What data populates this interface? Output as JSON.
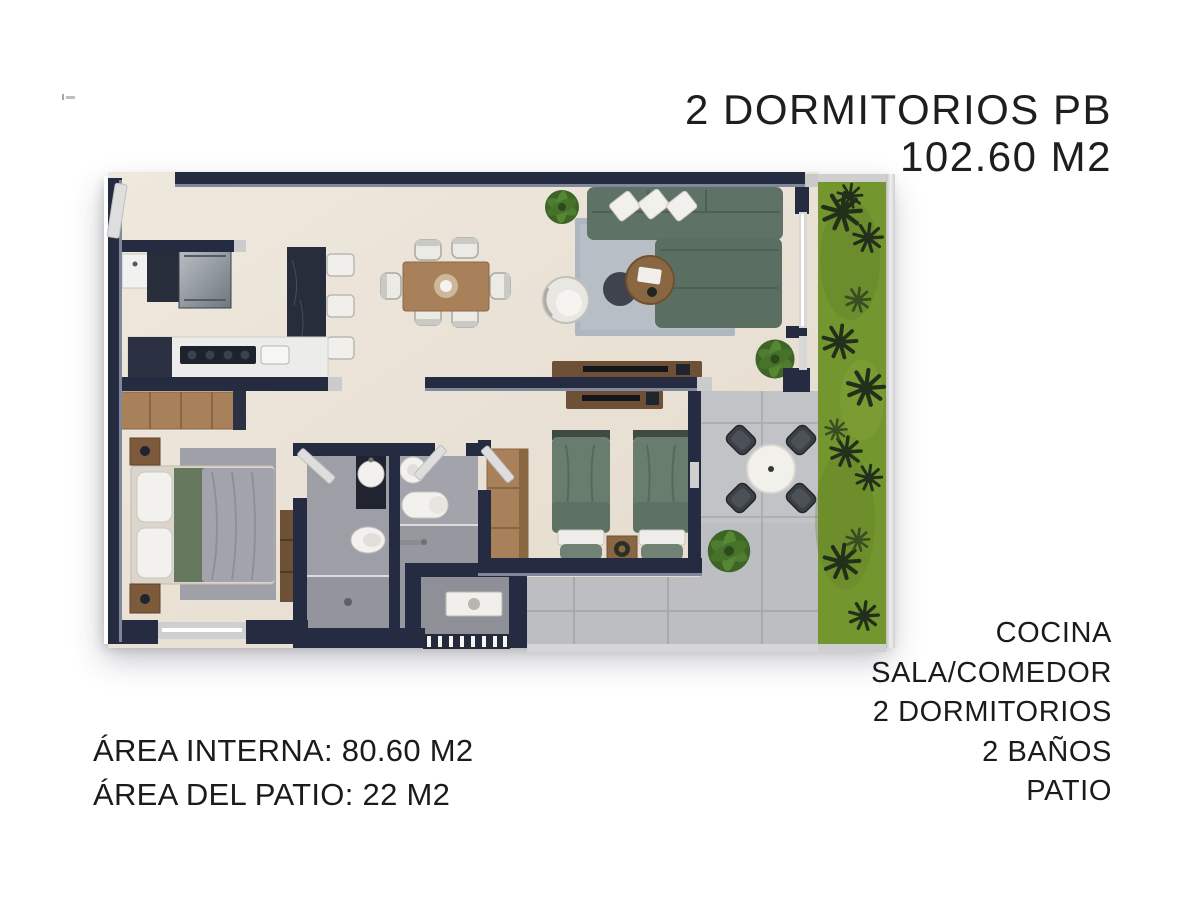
{
  "header": {
    "title_lines": [
      "2 DORMITORIOS PB",
      "102.60 M2"
    ]
  },
  "areas": {
    "lines": [
      "ÁREA INTERNA: 80.60 M2",
      "ÁREA DEL PATIO: 22 M2"
    ]
  },
  "features": {
    "items": [
      "COCINA",
      "SALA/COMEDOR",
      "2 DORMITORIOS",
      "2 BAÑOS",
      "PATIO"
    ]
  },
  "palette": {
    "text": "#1b1b1b",
    "wall": "#252c41",
    "wall_edge": "#9aa0b2",
    "floor": "#e9e1d5",
    "bath_floor": "#9e9ea6",
    "shower_floor": "#94949d",
    "patio_tile": "#bdbec2",
    "patio_grout": "#a8a9ad",
    "grass": "#74962e",
    "plant_dark": "#22301b",
    "sofa_green": "#5e7366",
    "bed_green": "#687d6e",
    "wood": "#a8815a",
    "wood_dark": "#6e5036",
    "island_dark": "#272d3a",
    "fixture_white": "#f2f1ed",
    "rug_living": "#aeb6bf",
    "rug_bedroom": "#a0a0a8",
    "duvet_gray": "#a3a3ab",
    "appliance_gray": "#8d949c",
    "curb_light": "#cbcbcb"
  }
}
